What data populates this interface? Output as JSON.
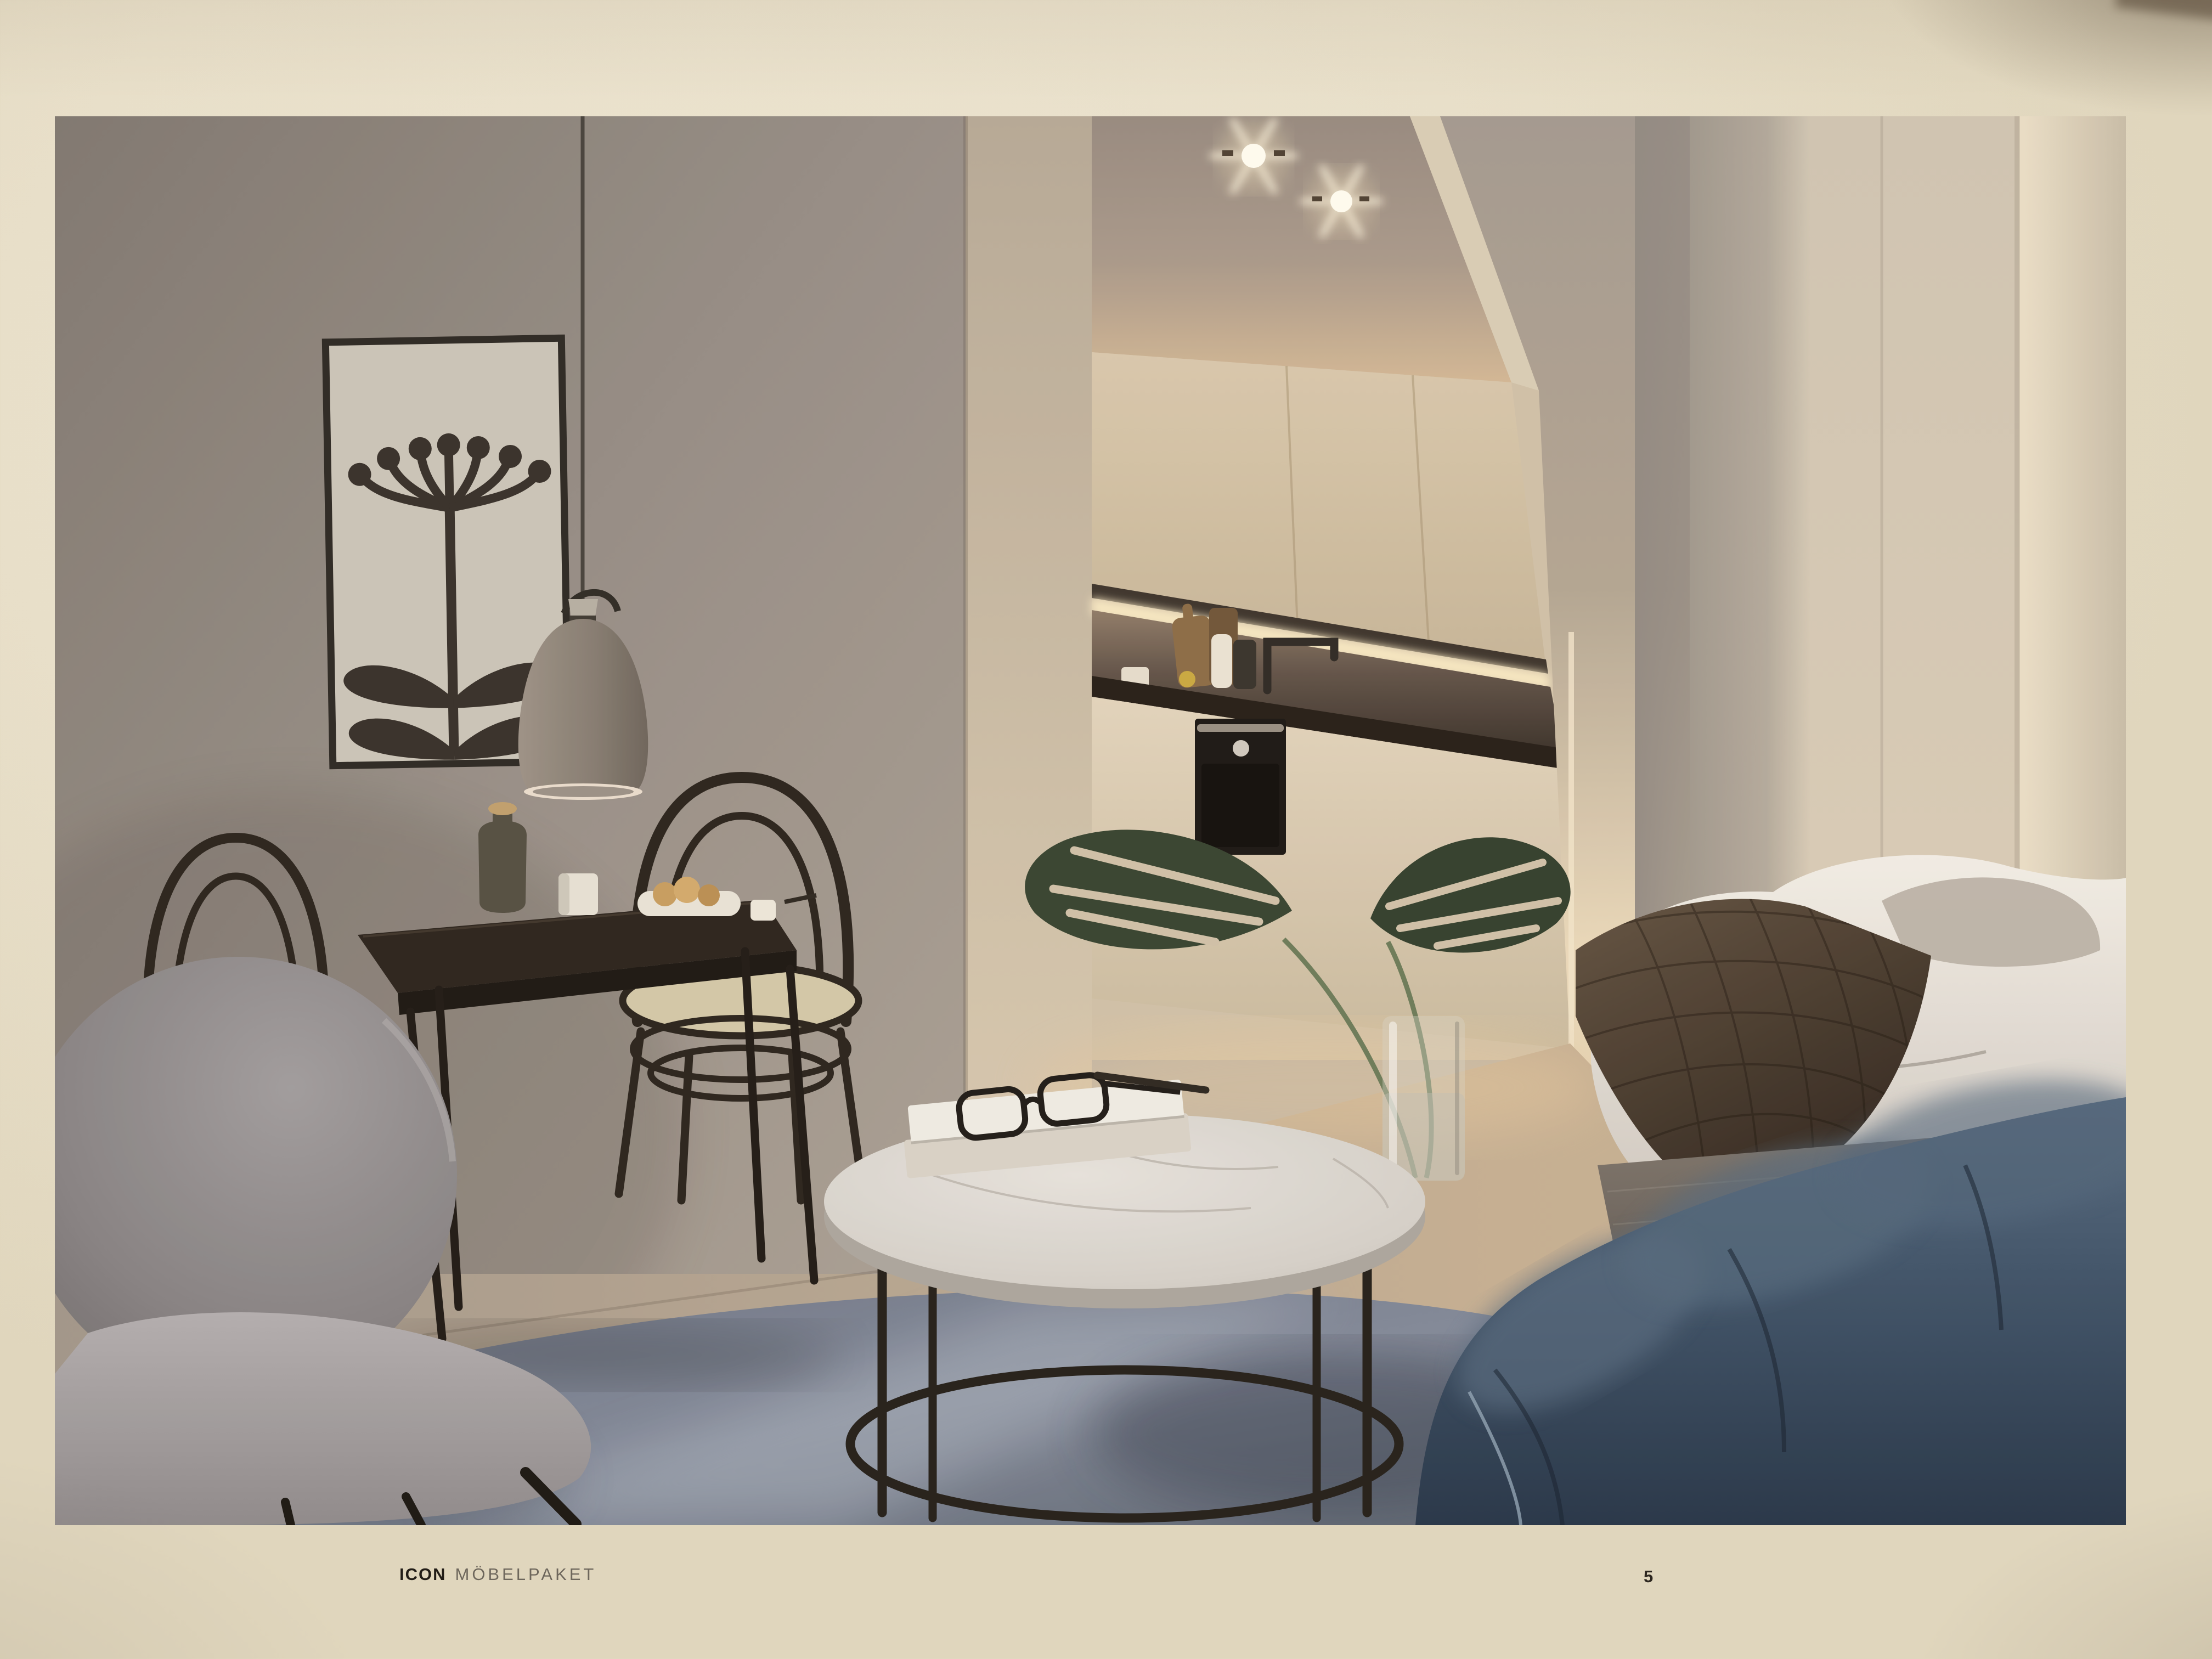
{
  "footer": {
    "series": "ICON",
    "label": "MÖBELPAKET",
    "page_number": "5"
  },
  "palette": {
    "paper_cream": "#e8dfc9",
    "wall_greige": "#908880",
    "warm_wall": "#d8cab3",
    "kitchen_glow": "#f6e7c0",
    "counter_dark": "#241d17",
    "wood_floor": "#bfa98d",
    "rug_blue_gray": "#7e8798",
    "sofa_navy": "#34485e",
    "bed_quilt_brown": "#4a3a30",
    "duvet_white": "#e9e5de",
    "marble_white": "#d7d3cd",
    "plant_green": "#34422f",
    "frame_black": "#2a2520",
    "cane_seat": "#d2c8a8",
    "lamp_gray": "#8a8177"
  }
}
